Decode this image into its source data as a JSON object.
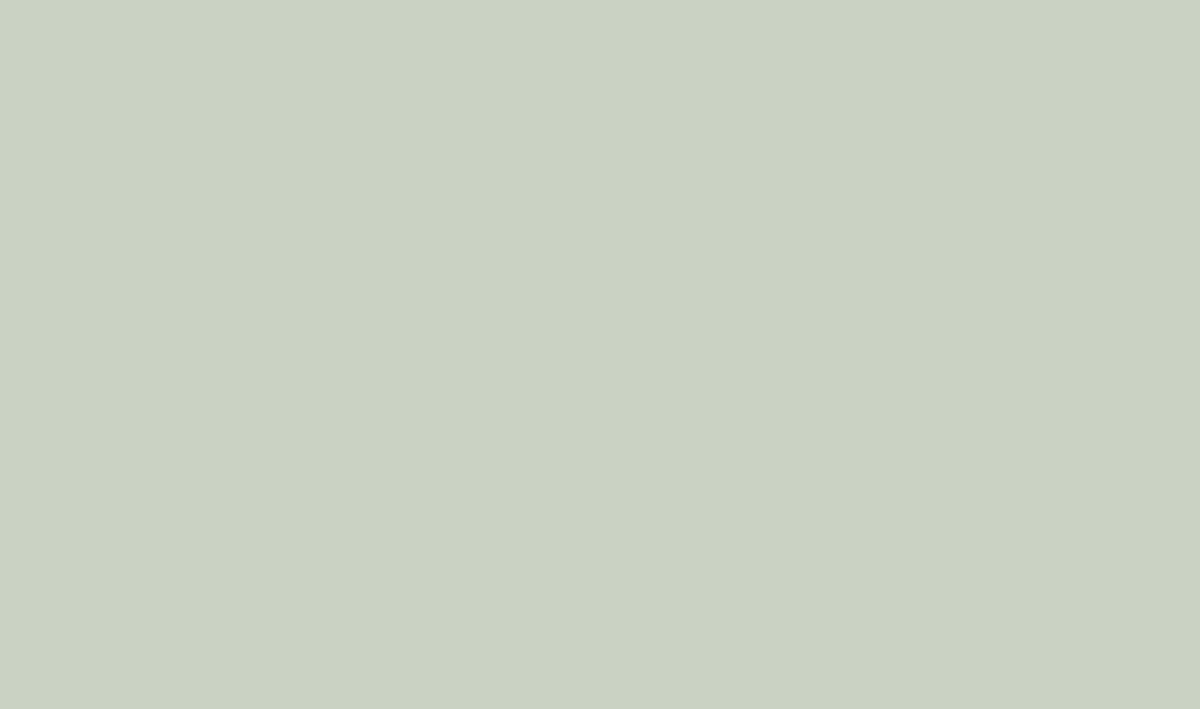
{
  "image": {
    "type": "architectural-aerial-rendering",
    "description": "Bird's-eye masterplan rendering of a riverfront civic and commercial campus: a cable-stayed bridge crosses a rowing river, a red running track lines the bank, a central circular plaza with an amber elevated ring walkway links a green-roof sports hall, a white mid-rise tower, a long slab building with rooftop solar panels and glass atrium, and a large curved mall with green roofs; red sports courts, parking lots, foggy grey residential massing blocks and a flock of white birds over a hazy city complete the scene."
  },
  "scene": {
    "elements": [
      "river",
      "cable-stayed-bridge",
      "rowing-boats",
      "riverside-running-track",
      "circular-viewing-deck",
      "central-plaza",
      "elevated-ring-walkway",
      "green-roof-hall",
      "hotel-tower",
      "slab-building-with-solar-roof",
      "glass-atrium",
      "curved-mall-building",
      "sunken-courtyard",
      "gate-pavilions",
      "sports-courts",
      "main-street",
      "intersection",
      "parking-lot",
      "residential-massing-blocks",
      "far-city-blocks",
      "flock-of-birds",
      "fog",
      "lens-flare",
      "crowds-of-people",
      "trees"
    ]
  },
  "palette": {
    "base": "#c9d3c3",
    "water": "#9dbccc",
    "waterLight": "#c4d8de",
    "waterDeep": "#8fb3c6",
    "cityBase": "#b5bdb3",
    "boxTop": "#c9ced5",
    "boxFront": "#9aa3ac",
    "boxSide": "#868f99",
    "nearBoxTop": "#bfc5cc",
    "nearBoxFront": "#939ca6",
    "nearBoxSide": "#7e8792",
    "landGreen": "#9cb083",
    "campus": "#e0e5df",
    "lawn": "#a6c35c",
    "lawnField": "#96b457",
    "lawnPale": "#b3c878",
    "treeDark": "#46593a",
    "treeMid": "#5a7347",
    "treeLight": "#73905a",
    "trackRed": "#d2686b",
    "courtRed": "#d4696b",
    "amber": "#ecc76d",
    "amberDeep": "#dfae4e",
    "gold": "#e9bd4a",
    "boardwalk": "#d9b87f",
    "deckTan": "#d8b571",
    "tanPad": "#c9a87f",
    "roofGreen": "#8fc04c",
    "roofGreenLight": "#a5cd5e",
    "white": "#f4f6f7",
    "facade": "#dfe6ea",
    "glass": "#a9c4d6",
    "glassRoof": "#bcd6e2",
    "solar": "#43546a",
    "road": "#767d84",
    "roadLight": "#8f969c",
    "paving": "#e9eceb",
    "concrete": "#ccd2d0",
    "shadow": "#5c6670",
    "haze": "#ffffff"
  }
}
